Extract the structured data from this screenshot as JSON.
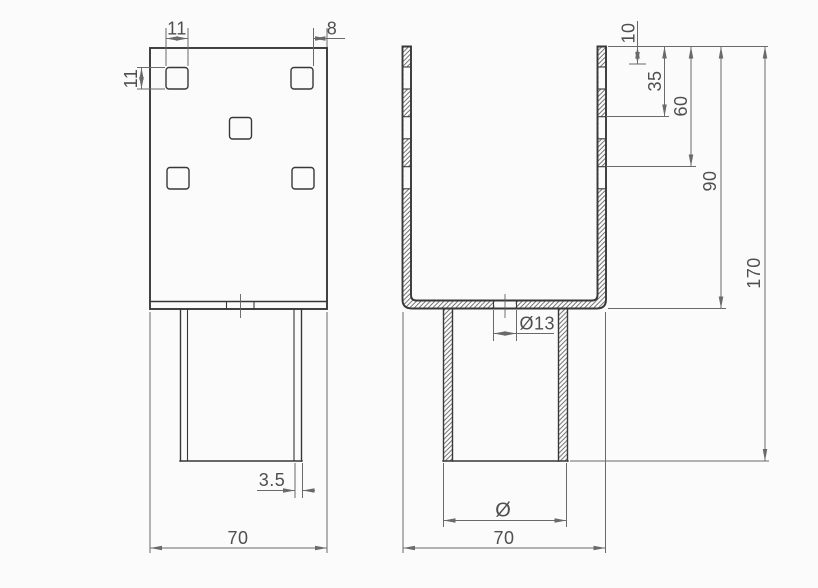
{
  "drawing": {
    "type": "technical-drawing",
    "description": "Two-view engineering drawing of a post anchor bracket: front view with five square holes and support tube, and section view of U-channel with hatched cut walls",
    "colors": {
      "background": "#fbfbfb",
      "object-line": "#383838",
      "dim-line": "#6a6a6a",
      "text-color": "#4f4f4f",
      "hatch-color": "#5a5a5a"
    },
    "front_view": {
      "label": "front-view",
      "dims": {
        "square_width": "11",
        "square_height": "11",
        "edge_offset": "8",
        "wall_thickness": "3.5",
        "overall_width": "70"
      }
    },
    "section_view": {
      "label": "section-view",
      "dims": {
        "hole_row_1": "10",
        "hole_row_2": "35",
        "hole_row_3": "60",
        "channel_depth": "90",
        "overall_height": "170",
        "web_hole_diameter": "Ø13",
        "tube_diameter": "Ø",
        "overall_width": "70"
      }
    }
  }
}
